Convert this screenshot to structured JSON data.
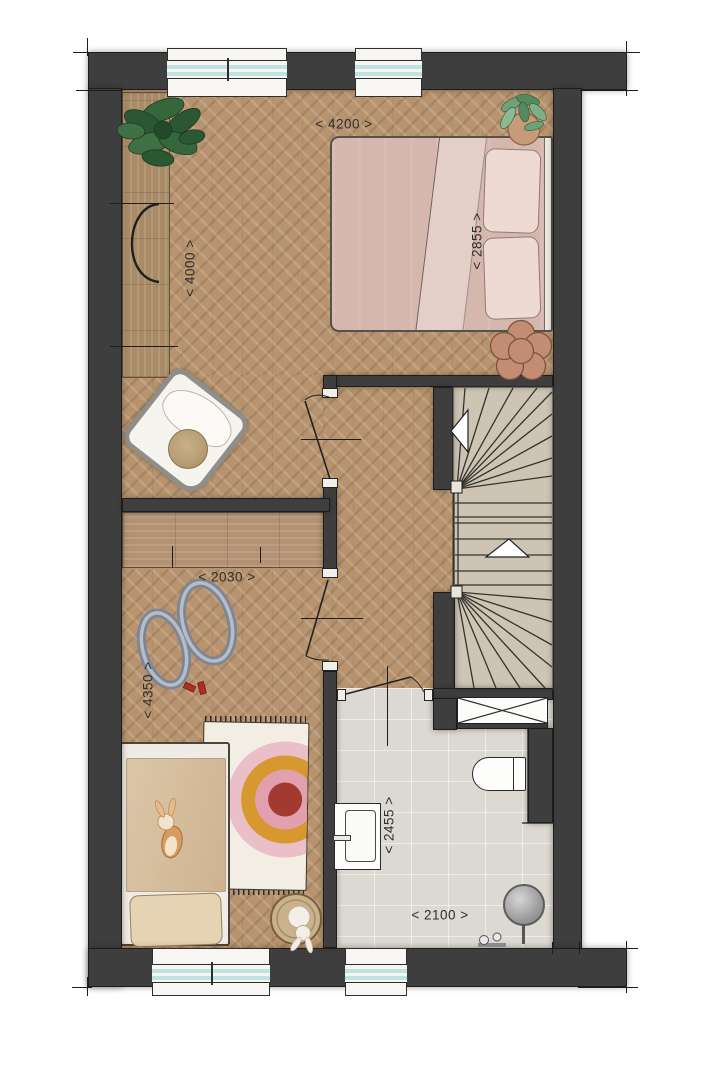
{
  "dims": {
    "w4200": {
      "text": "< 4200 >"
    },
    "d2855": {
      "text": "< 2855 >"
    },
    "d4000": {
      "text": "< 4000 >"
    },
    "w2030": {
      "text": "< 2030 >"
    },
    "d4350": {
      "text": "< 4350 >"
    },
    "d2455": {
      "text": "< 2455 >"
    },
    "w2100": {
      "text": "< 2100 >"
    }
  },
  "palette": {
    "wall": "#3e3e3e",
    "floor-wood": "#b7946f",
    "floor-tile": "#dcd9d2",
    "stair": "#cdc4b4",
    "glass": "#bfe3e0",
    "duvet-pink": "#d6b7ae",
    "duvet-beige": "#dcc6a6",
    "pouf": "#b49b71",
    "rainbow-outer": "#eabfc7",
    "rainbow-orange": "#d6982f",
    "rainbow-pink": "#e2a0ae",
    "rainbow-red": "#a23a31",
    "plant-green": "#2f5c35",
    "terracotta": "#c28d72"
  },
  "furniture": {
    "master_bedroom": [
      "double-bed",
      "pillows",
      "large-plant",
      "potted-plant",
      "desk",
      "desk-chair",
      "armchair",
      "pouf",
      "flower-stool"
    ],
    "kids_bedroom": [
      "single-bed",
      "plush-bunny",
      "rainbow-rug",
      "toy-race-track",
      "toy-cars",
      "wardrobe",
      "basket-with-bunny"
    ],
    "bathroom": [
      "washbasin",
      "toilet",
      "shower",
      "ventilation-shaft"
    ],
    "stairwell": [
      "winder-staircase",
      "direction-arrows"
    ]
  }
}
